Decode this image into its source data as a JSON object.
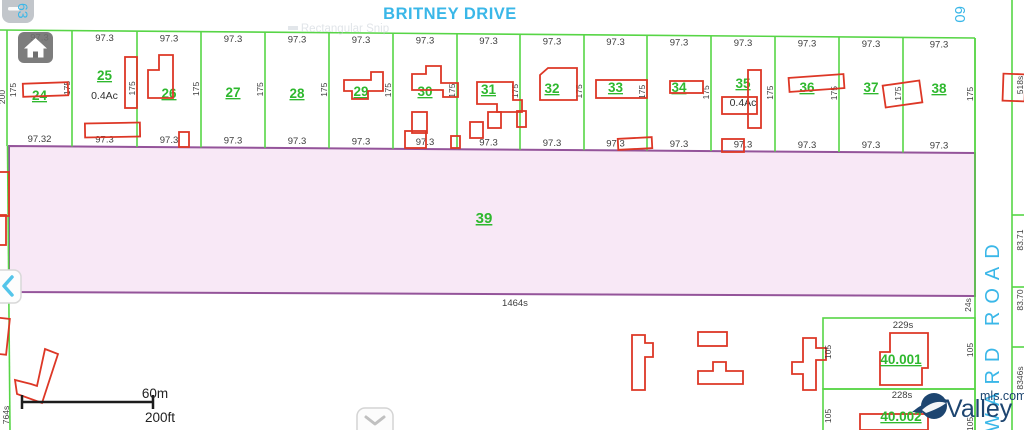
{
  "map": {
    "street_top": "BRITNEY DRIVE",
    "route_top_right": "60",
    "route_top_left": "63",
    "road_right": "WARD ROAD",
    "snip_ghost": "Rectangular Snip",
    "parcels": [
      {
        "id": "24",
        "top": "97.3",
        "bottom": "97.32",
        "side": "175"
      },
      {
        "id": "25",
        "top": "97.3",
        "bottom": "97.3",
        "side": "175",
        "area": "0.4Ac"
      },
      {
        "id": "26",
        "top": "97.3",
        "bottom": "97.3",
        "side": "175"
      },
      {
        "id": "27",
        "top": "97.3",
        "bottom": "97.3",
        "side": "175"
      },
      {
        "id": "28",
        "top": "97.3",
        "bottom": "97.3",
        "side": "175"
      },
      {
        "id": "29",
        "top": "97.3",
        "bottom": "97.3",
        "side": "175"
      },
      {
        "id": "30",
        "top": "97.3",
        "bottom": "97.3",
        "side": "175"
      },
      {
        "id": "31",
        "top": "97.3",
        "bottom": "97.3",
        "side": "175"
      },
      {
        "id": "32",
        "top": "97.3",
        "bottom": "97.3",
        "side": "175"
      },
      {
        "id": "33",
        "top": "97.3",
        "bottom": "97.3",
        "side": "175"
      },
      {
        "id": "34",
        "top": "97.3",
        "bottom": "97.3",
        "side": "175"
      },
      {
        "id": "35",
        "top": "97.3",
        "bottom": "97.3",
        "side": "175",
        "area": "0.4Ac"
      },
      {
        "id": "36",
        "top": "97.3",
        "bottom": "97.3",
        "side": "175"
      },
      {
        "id": "37",
        "top": "97.3",
        "bottom": "97.3",
        "side": "175"
      },
      {
        "id": "38",
        "top": "97.3",
        "bottom": "97.3",
        "side": "175"
      }
    ],
    "left_strip": {
      "depth": "200",
      "side": "175",
      "bottom": "764s"
    },
    "parcel_39": {
      "id": "39",
      "bottom_len": "1464s",
      "right_side": "24s"
    },
    "right_strip": {
      "labels": [
        "518s",
        "83.71",
        "83.70",
        "8346s"
      ]
    },
    "parcel_40_001": {
      "id": "40.001",
      "top": "229s",
      "left": "105",
      "right": "105"
    },
    "parcel_40_002": {
      "id": "40.002",
      "top": "228s",
      "left": "105",
      "right": "105"
    },
    "scale": {
      "metric": "60m",
      "imperial": "200ft"
    },
    "logo": {
      "name": "Valley",
      "suffix": "mls.com"
    }
  },
  "colors": {
    "line_green": "#57d546",
    "parcel_text_green": "#2eb82e",
    "building_red": "#dd3726",
    "parcel39_fill": "#f8e8f6",
    "parcel39_border": "#94549a",
    "road_cyan": "#3ab7e8",
    "logo_navy": "#1d4570"
  }
}
